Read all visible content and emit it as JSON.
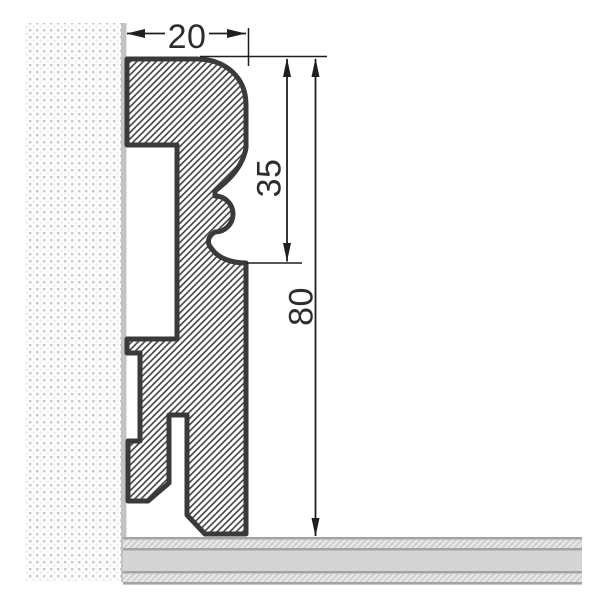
{
  "drawing": {
    "type": "technical-cross-section",
    "dimensions": [
      {
        "value": "20",
        "orientation": "horizontal"
      },
      {
        "value": "35",
        "orientation": "vertical"
      },
      {
        "value": "80",
        "orientation": "vertical"
      }
    ]
  },
  "colors": {
    "background": "#ffffff",
    "outline": "#3a3a3a",
    "hatch": "#3f3f3f",
    "wall_line": "#c3c3c3",
    "wall_dot": "#c9c9c9",
    "floor_gray": "#d5d5d5",
    "floor_border": "#a3a3a3",
    "floor_hatch_bg": "#e8e8e8",
    "dimension": "#1f1f1f"
  }
}
